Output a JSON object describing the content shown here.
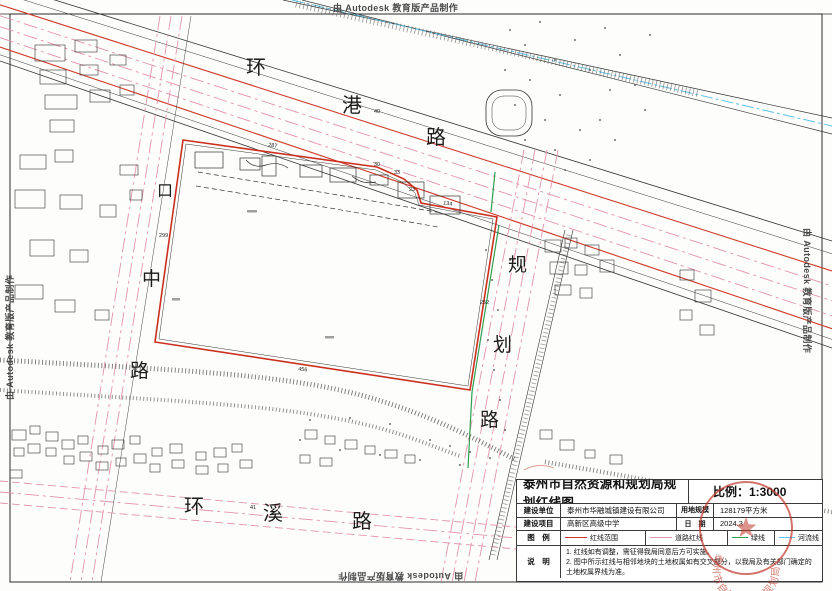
{
  "watermarks": {
    "top": "由 Autodesk 教育版产品制作",
    "right": "由 Autodesk 教育版产品制作",
    "bottom": "由 Autodesk 教育版产品制作",
    "left": "由 Autodesk 教育版产品制作"
  },
  "roads": {
    "huangang": {
      "name": "环港路",
      "chars": [
        "环",
        "港",
        "路"
      ]
    },
    "west": {
      "name": "口中路",
      "chars": [
        "口",
        "中",
        "路"
      ]
    },
    "guihua": {
      "name": "规划路",
      "chars": [
        "规",
        "划",
        "路"
      ]
    },
    "huanxi": {
      "name": "环溪路",
      "chars": [
        "环",
        "溪",
        "路"
      ]
    }
  },
  "dimensions": {
    "top_edge": "287",
    "west_edge": "299",
    "road_width": "40",
    "jog_a": "30",
    "jog_b": "33",
    "jog_c": "23",
    "ne_edge": "134",
    "east_edge": "252",
    "south_edge": "456",
    "huanxi_width": "41"
  },
  "title_block": {
    "title": "泰州市自然资源和规划局规划红线图",
    "scale": "比例：1:3000",
    "fields": {
      "unit_label": "建设单位",
      "unit_value": "泰州市华融城镇建设有限公司",
      "area_label": "用地规模",
      "area_value": "128179平方米",
      "project_label": "建设项目",
      "project_value": "高新区高级中学",
      "date_label": "日　期",
      "date_value": "2024.3",
      "legend_label": "图　例",
      "notes_label": "说　明"
    },
    "legend": [
      {
        "label": "红线范围",
        "color": "#c43a2a"
      },
      {
        "label": "道路红线",
        "color": "#e493ad"
      },
      {
        "label": "绿线",
        "color": "#2f9e4e"
      },
      {
        "label": "河流线",
        "color": "#5ec3e6"
      }
    ],
    "notes": [
      "1. 红线如有调整，需征得我局同意后方可实施。",
      "2. 图中所示红线与相邻地块的土地权属如有交叉部分，以我局及有关部门确定的土地权属界线为准。"
    ]
  },
  "seal": {
    "text": "泰州市自然资源和规划局"
  }
}
